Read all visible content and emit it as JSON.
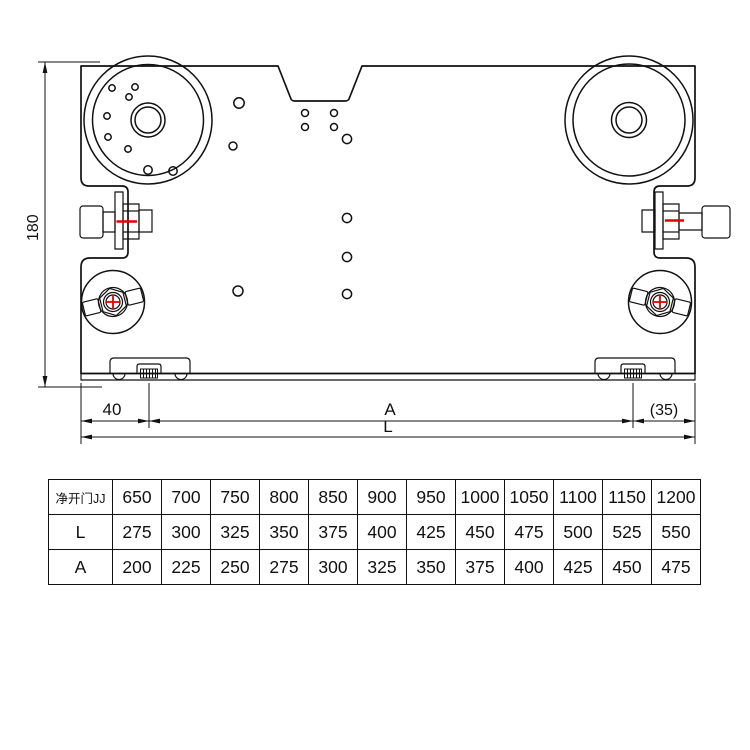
{
  "page": {
    "background": "#ffffff"
  },
  "drawing": {
    "line_color": "#111111",
    "accent_color": "#e60000",
    "dimensions": {
      "height": "180",
      "left_offset": "40",
      "center_span": "A",
      "right_offset": "(35)",
      "total_length": "L"
    }
  },
  "table": {
    "matrix": [
      [
        "净开门JJ",
        "650",
        "700",
        "750",
        "800",
        "850",
        "900",
        "950",
        "1000",
        "1050",
        "1100",
        "1150",
        "1200"
      ],
      [
        "L",
        "275",
        "300",
        "325",
        "350",
        "375",
        "400",
        "425",
        "450",
        "475",
        "500",
        "525",
        "550"
      ],
      [
        "A",
        "200",
        "225",
        "250",
        "275",
        "300",
        "325",
        "350",
        "375",
        "400",
        "425",
        "450",
        "475"
      ]
    ]
  }
}
